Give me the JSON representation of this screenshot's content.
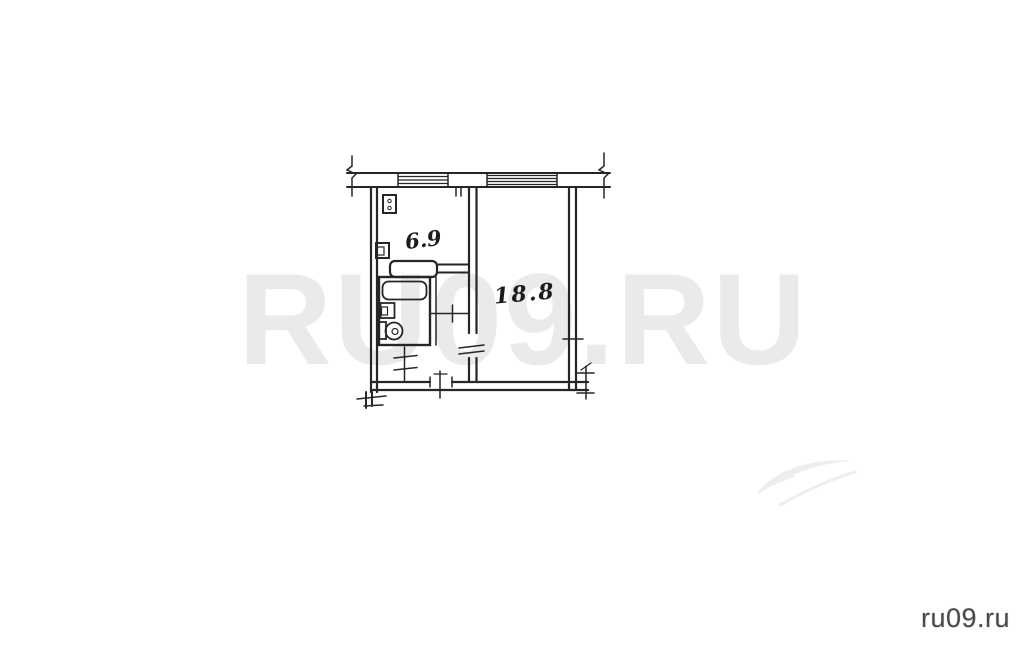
{
  "watermark": {
    "text": "RU09.RU"
  },
  "site_logo": {
    "text": "ru09.ru"
  },
  "floor_plan": {
    "kitchen_area_label": "6.9",
    "room_area_label": "18.8",
    "fixture_icons": [
      "stove-icon",
      "vent-icon",
      "bathtub-icon",
      "sink-icon",
      "toilet-icon"
    ],
    "symbols": [
      "window-band",
      "wall-break-mark",
      "entrance-door-mark",
      "interior-door-marks"
    ]
  },
  "colors": {
    "background": "#ffffff",
    "ink": "#262626",
    "watermark": "#eaeaea",
    "swoosh": "#eeeeee",
    "logo_text": "#4a4a4a",
    "label_ink": "#1c1c1c"
  }
}
